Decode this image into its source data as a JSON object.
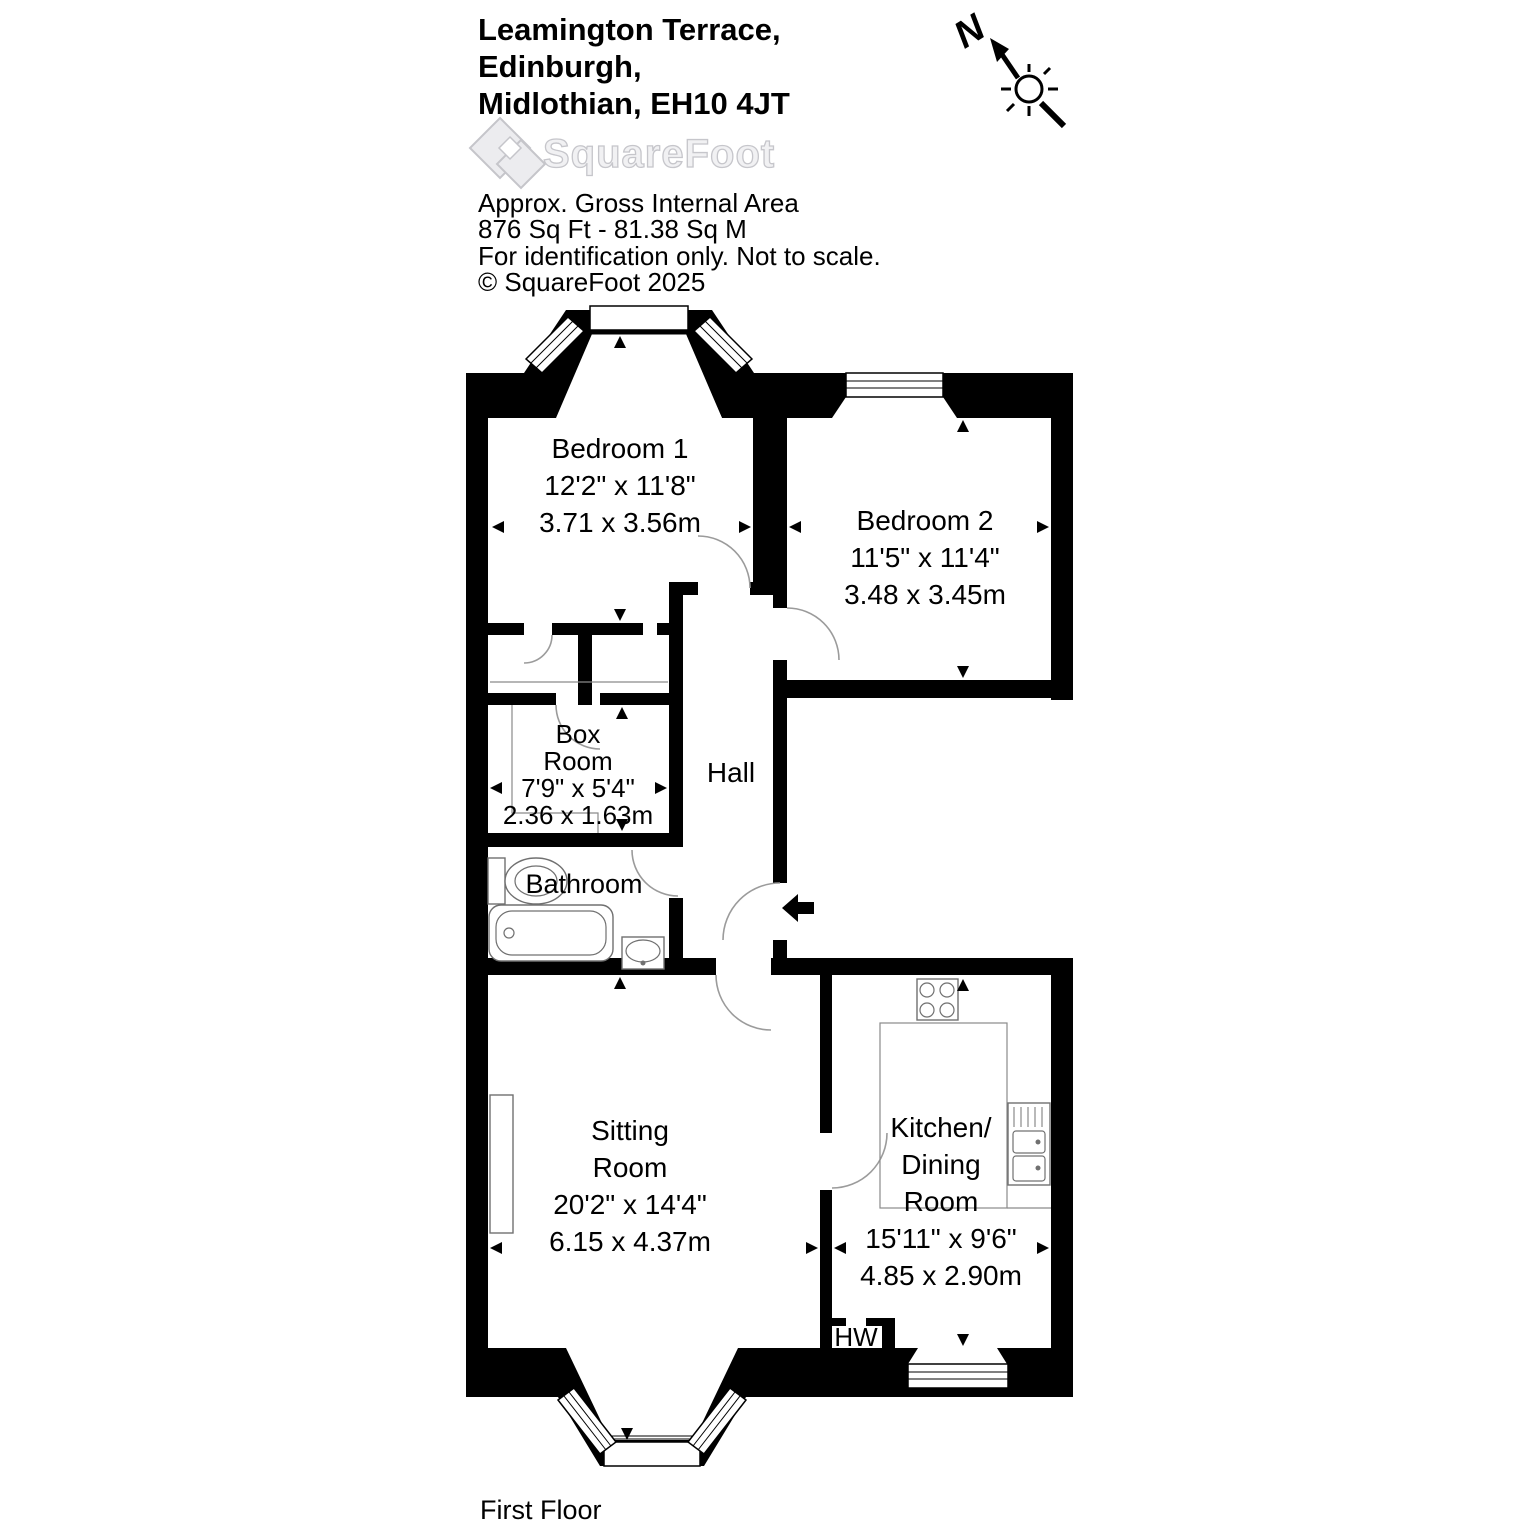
{
  "header": {
    "title_lines": [
      "Leamington Terrace,",
      "Edinburgh,",
      "Midlothian, EH10 4JT"
    ],
    "brand": "SquareFoot",
    "area_title": "Approx. Gross Internal Area",
    "area_values": "876 Sq Ft  -  81.38 Sq M",
    "disclaimer": "For identification only. Not to scale.",
    "copyright": "© SquareFoot 2025"
  },
  "compass": {
    "north_label": "N"
  },
  "plan": {
    "floor_label": "First Floor",
    "rooms": {
      "bedroom1": {
        "name": "Bedroom 1",
        "dims_ft": "12'2\" x 11'8\"",
        "dims_m": "3.71 x 3.56m"
      },
      "bedroom2": {
        "name": "Bedroom 2",
        "dims_ft": "11'5\" x 11'4\"",
        "dims_m": "3.48 x 3.45m"
      },
      "box_room": {
        "name_line1": "Box",
        "name_line2": "Room",
        "dims_ft": "7'9\" x 5'4\"",
        "dims_m": "2.36 x 1.63m"
      },
      "hall": {
        "name": "Hall"
      },
      "bathroom": {
        "name": "Bathroom"
      },
      "sitting_room": {
        "name_line1": "Sitting",
        "name_line2": "Room",
        "dims_ft": "20'2\" x 14'4\"",
        "dims_m": "6.15 x 4.37m"
      },
      "kitchen": {
        "name_line1": "Kitchen/",
        "name_line2": "Dining",
        "name_line3": "Room",
        "dims_ft": "15'11\" x 9'6\"",
        "dims_m": "4.85 x 2.90m"
      },
      "hot_water": {
        "name": "HW"
      }
    }
  },
  "colors": {
    "walls": "#000000",
    "text": "#000000",
    "fixtures": "#707070",
    "door_arcs": "#9b9b9b",
    "logo_gray": "#d8d8dc"
  }
}
